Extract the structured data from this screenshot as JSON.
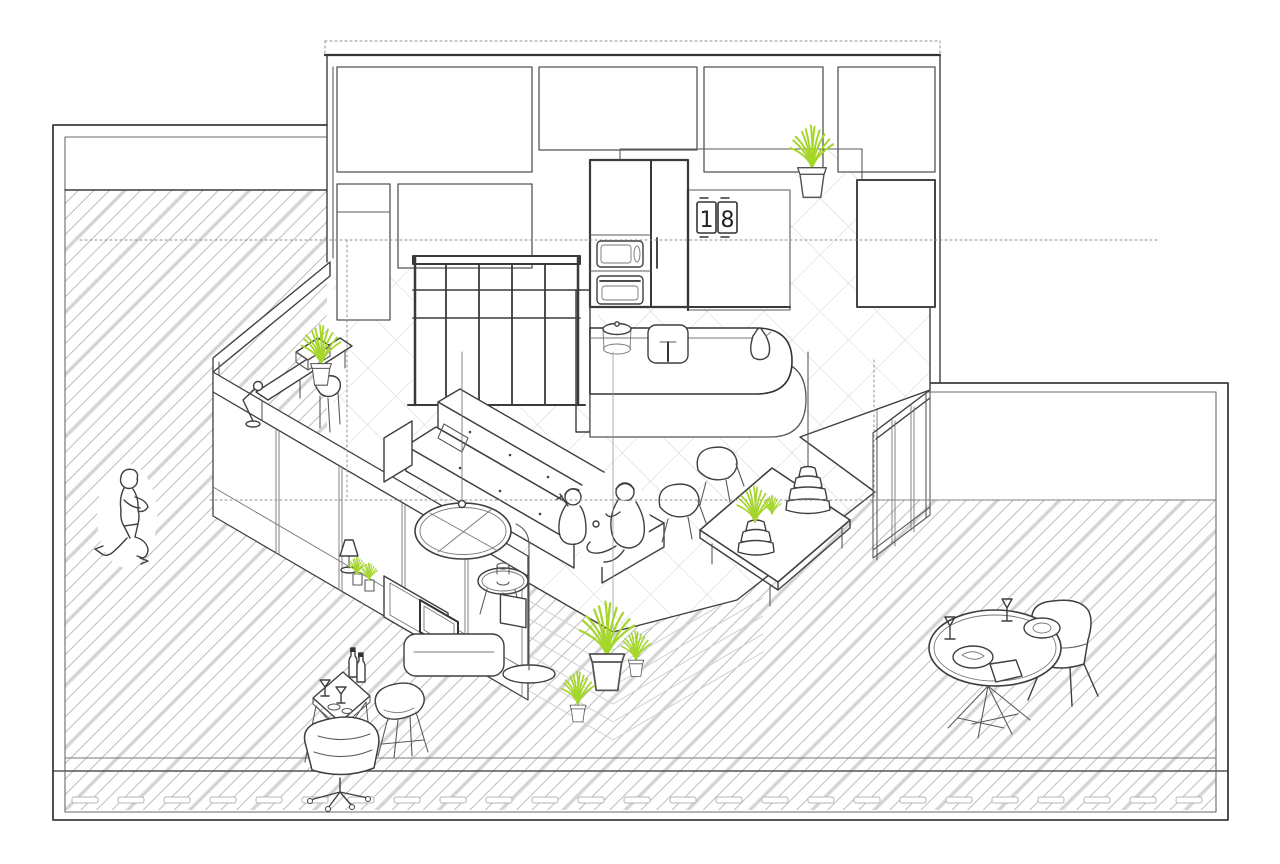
{
  "scene": {
    "title": "Isometric apartment interior illustration",
    "style": "black-and-white architectural line drawing with green plant accents",
    "colors": {
      "background": "#ffffff",
      "line": "#3f3f3f",
      "dark_line": "#333333",
      "hatch_thin": "#bdbdbd",
      "hatch_thick": "#dedede",
      "tile_grid": "#d0d0d0",
      "plant_green": "#a5d62b",
      "dotted_guide": "#8c8c8c"
    },
    "wall_clock": {
      "digit_left": "1",
      "digit_right": "8"
    },
    "areas": [
      {
        "id": "left-terrace",
        "label": "Left terrace with diagonal hatching"
      },
      {
        "id": "top-elevation",
        "label": "Back wall elevation with room panels"
      },
      {
        "id": "kitchen",
        "label": "Kitchen with oven column, island, sink"
      },
      {
        "id": "tiled-floor",
        "label": "Diamond-tiled interior floor"
      },
      {
        "id": "lounge",
        "label": "Sunken lounge with sofa and coffee table"
      },
      {
        "id": "dining",
        "label": "Dining corner with glass walls"
      },
      {
        "id": "right-terrace",
        "label": "Right terrace with diagonal hatching"
      },
      {
        "id": "deck-band",
        "label": "Bottom wood deck edge band"
      }
    ],
    "objects": [
      "potted-plant-top-right",
      "wall-clock-18",
      "oven-column-with-microwave-and-oven",
      "kitchen-island-with-pot-sink-kettle",
      "shelving-unit-grid",
      "desk-with-typewriter",
      "articulated-desk-lamp",
      "desk-chair",
      "l-shaped-sofa",
      "round-glass-coffee-table",
      "pendant-bulb-over-table",
      "side-table-with-cup",
      "floor-lamp",
      "tv-screen",
      "tv-media-console",
      "leaning-picture-frame",
      "ledge-cone-lamp",
      "ledge-mini-plants",
      "dining-table",
      "two-shell-dining-chairs",
      "tiered-pendant-lamp",
      "tiered-vase-with-plant",
      "three-corner-potted-plants",
      "running-child",
      "two-children-playing",
      "cocktail-table-with-wine-bottles-and-glasses",
      "eames-shell-chair",
      "swivel-lounge-chair",
      "outdoor-round-table-with-glasses-and-plates",
      "outdoor-dining-chairs",
      "wood-deck-dashes"
    ]
  }
}
